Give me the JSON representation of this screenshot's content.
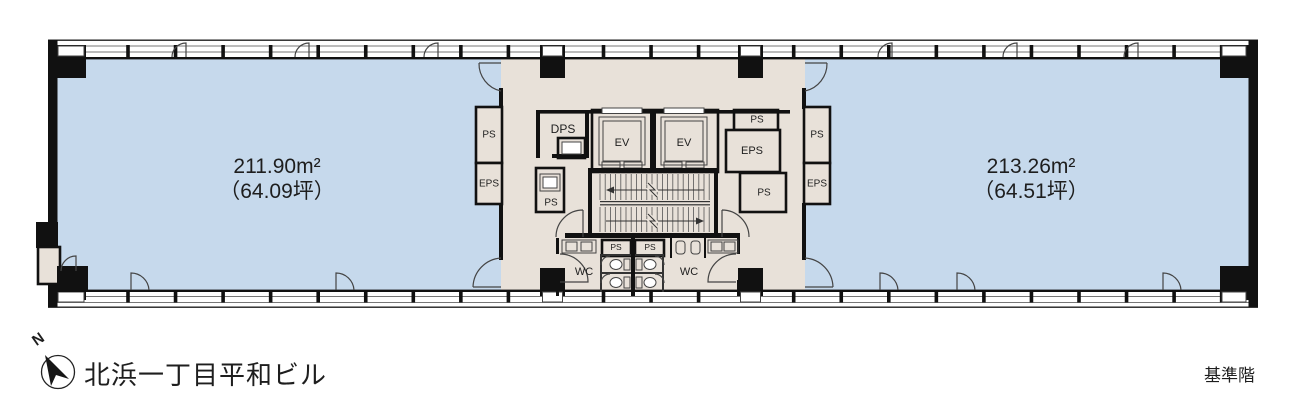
{
  "building": {
    "name": "北浜一丁目平和ビル",
    "floor_label": "基準階"
  },
  "compass": {
    "north": "N"
  },
  "tenants": {
    "left": {
      "area_m2": "211.90m²",
      "area_tsubo": "（64.09坪）"
    },
    "right": {
      "area_m2": "213.26m²",
      "area_tsubo": "（64.51坪）"
    }
  },
  "room_labels": {
    "ev": "EV",
    "dps": "DPS",
    "eps": "EPS",
    "ps": "PS",
    "wc": "WC"
  },
  "colors": {
    "tenant_fill": "#c6d9ec",
    "core_fill": "#e8e1d9",
    "wall": "#111111"
  }
}
